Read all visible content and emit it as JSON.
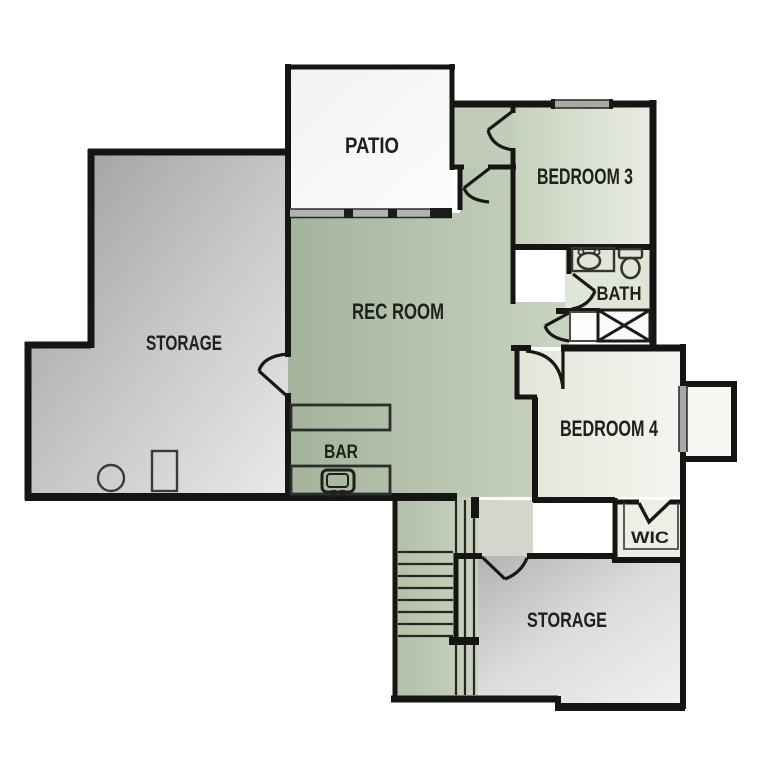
{
  "figure": {
    "type": "floor-plan",
    "level": "basement-lower-level"
  },
  "rooms": [
    {
      "id": "patio",
      "label": "PATIO"
    },
    {
      "id": "storage_left",
      "label": "STORAGE"
    },
    {
      "id": "rec_room",
      "label": "REC ROOM"
    },
    {
      "id": "bedroom_3",
      "label": "BEDROOM 3"
    },
    {
      "id": "bath",
      "label": "BATH"
    },
    {
      "id": "bar",
      "label": "BAR"
    },
    {
      "id": "bedroom_4",
      "label": "BEDROOM 4"
    },
    {
      "id": "wic",
      "label": "WIC"
    },
    {
      "id": "storage_lower",
      "label": "STORAGE"
    }
  ],
  "fixtures": [
    "bathroom-sink",
    "toilet",
    "shower-x-box",
    "linen-closet",
    "bar-sink",
    "bar-counter",
    "water-heater-circle",
    "utility-box",
    "staircase",
    "sliding-patio-door",
    "window-bedroom3",
    "bay-window-bedroom4",
    "door-arcs",
    "bifold-wic-door"
  ],
  "colors": {
    "background": "#ffffff",
    "wall": "#151513",
    "rec_green_dark": "#a4b59c",
    "rec_green_light": "#c8d3c0",
    "bed3_green": "#c9d3c0",
    "bed4_light": "#e6eade",
    "storage_gray_dark": "#9e9e9c",
    "storage_gray_light": "#eaeae8",
    "window_gray": "#a8a8a6",
    "label_text": "#20201e"
  }
}
